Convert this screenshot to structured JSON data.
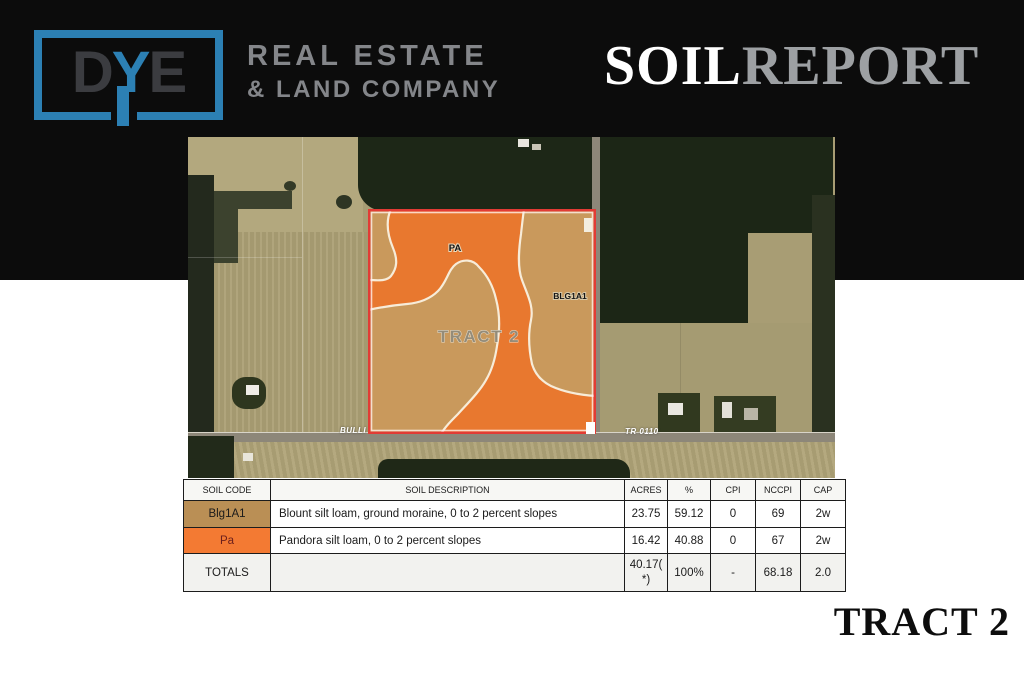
{
  "header": {
    "logo_d": "D",
    "logo_y": "Y",
    "logo_e": "E",
    "brand_line1": "REAL ESTATE",
    "brand_line2": "& LAND COMPANY",
    "title_part1": "SOIL",
    "title_part2": "REPORT"
  },
  "map": {
    "tract_label": "TRACT 2",
    "zone_label_pa": "PA",
    "zone_label_blg": "BLG1A1",
    "road_label_left": "BULLI",
    "road_label_right": "TR 0110",
    "colors": {
      "pa_orange": "#E8782F",
      "blg_tan": "#C9995C",
      "parcel_border_red": "#E23B35",
      "boundary_white": "#F7ECD9"
    }
  },
  "soil_table": {
    "columns": [
      "SOIL CODE",
      "SOIL DESCRIPTION",
      "ACRES",
      "%",
      "CPI",
      "NCCPI",
      "CAP"
    ],
    "rows": [
      {
        "code": "Blg1A1",
        "code_bg": "#BA8F55",
        "description": "Blount silt loam, ground moraine, 0 to 2 percent slopes",
        "acres": "23.75",
        "percent": "59.12",
        "cpi": "0",
        "nccpi": "69",
        "cap": "2w"
      },
      {
        "code": "Pa",
        "code_bg": "#F37A33",
        "description": "Pandora silt loam, 0 to 2 percent slopes",
        "acres": "16.42",
        "percent": "40.88",
        "cpi": "0",
        "nccpi": "67",
        "cap": "2w"
      }
    ],
    "totals": {
      "label": "TOTALS",
      "description": "",
      "acres": "40.17( *)",
      "percent": "100%",
      "cpi": "-",
      "nccpi": "68.18",
      "cap": "2.0"
    }
  },
  "footer": {
    "tract_label": "TRACT 2"
  }
}
